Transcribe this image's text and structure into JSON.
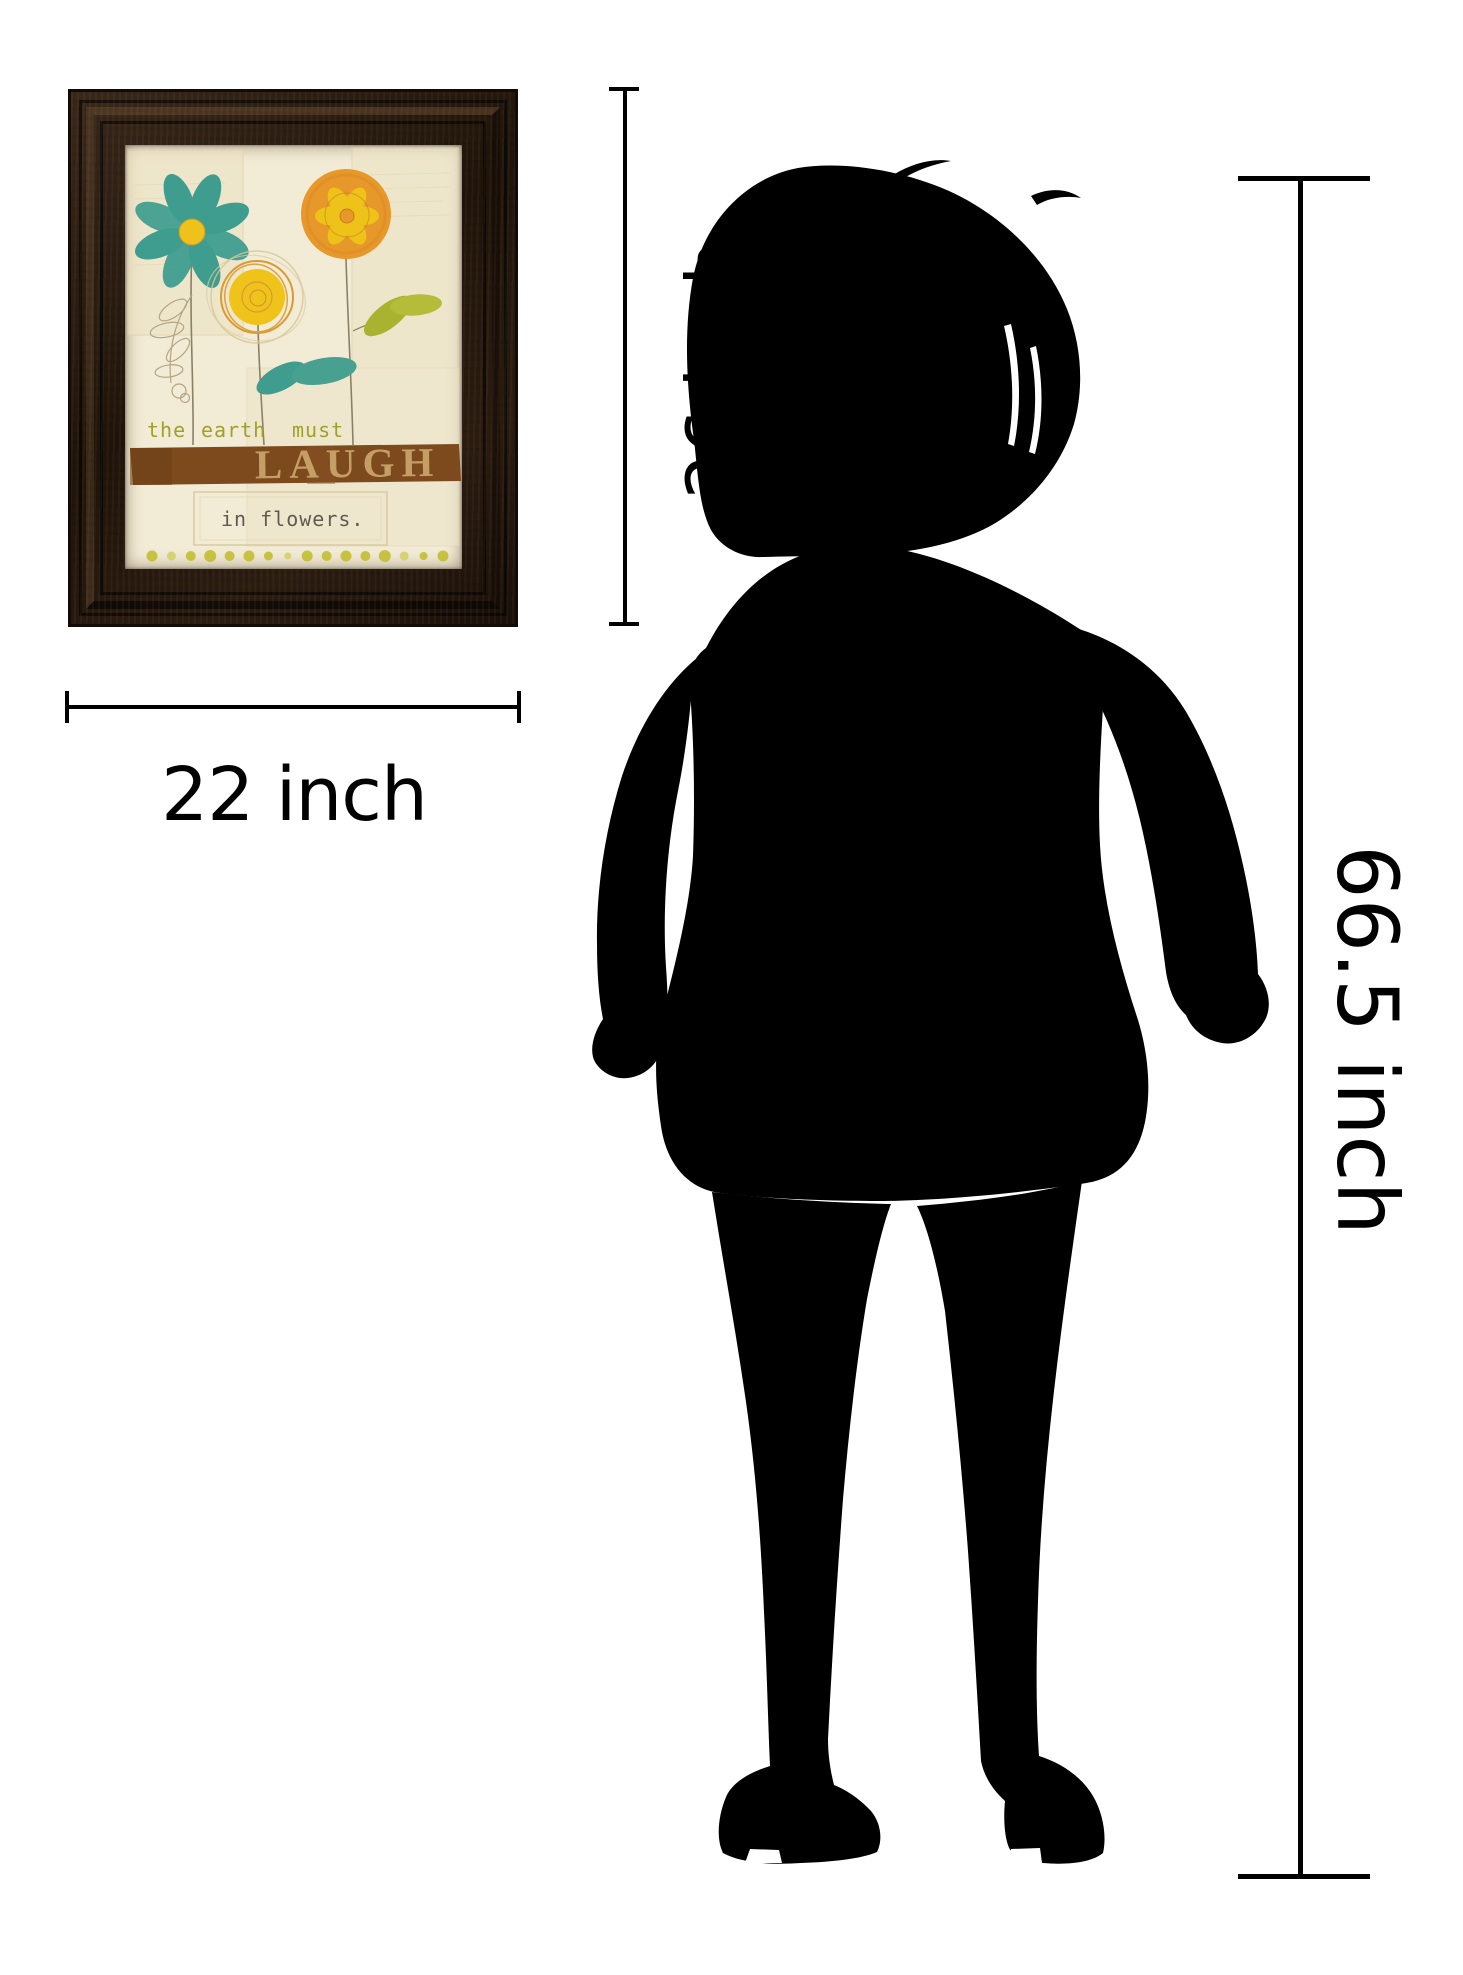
{
  "artwork": {
    "caption_words": [
      "the",
      "earth",
      "must"
    ],
    "laugh_text": "LAUGH",
    "subcaption": "in flowers.",
    "colors": {
      "frame": "#241811",
      "print_bg": "#f2ebd5",
      "teal": "#3e9d8e",
      "yellow": "#f0c31a",
      "orange": "#e7982a",
      "leaf_green": "#aab32f",
      "band_brown": "#7d4a1e",
      "band_text": "#c9a66c",
      "caption_olive": "#a1a02b",
      "subcaption_gray": "#5f5b51"
    }
  },
  "measurements": {
    "width_label": "22 inch",
    "height_label": "26 inch",
    "person_height_label": "66.5 inch"
  },
  "silhouette": {
    "subject": "standing woman silhouette",
    "color": "#000000"
  }
}
